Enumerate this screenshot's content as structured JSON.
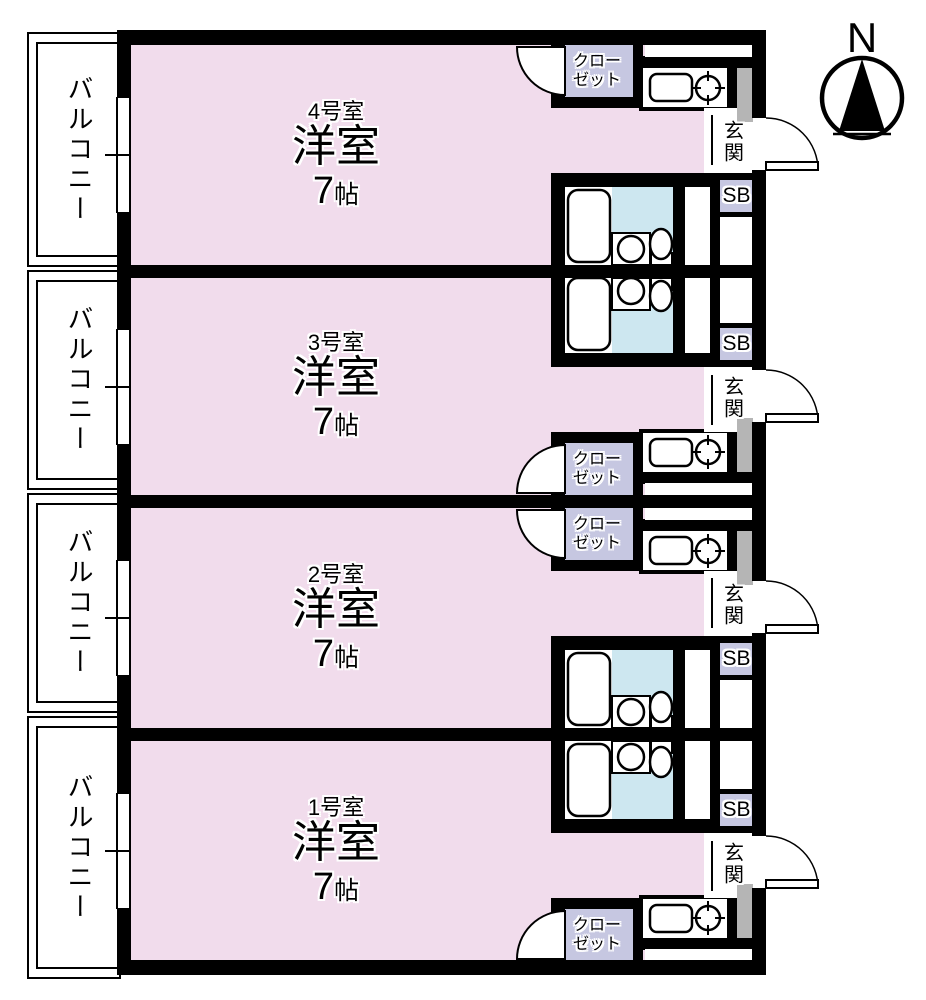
{
  "compass": {
    "north_label": "N"
  },
  "balconies": [
    {
      "label": "バルコニー"
    },
    {
      "label": "バルコニー"
    },
    {
      "label": "バルコニー"
    },
    {
      "label": "バルコニー"
    }
  ],
  "units": [
    {
      "number_label": "4号室"
    },
    {
      "number_label": "3号室"
    },
    {
      "number_label": "2号室"
    },
    {
      "number_label": "1号室"
    }
  ],
  "shared_labels": {
    "room_type": "洋室",
    "room_size_number": "7",
    "room_size_unit": "帖",
    "closet_line1": "クロー",
    "closet_line2": "ゼット",
    "entrance": "玄関",
    "shoe_box": "SB"
  },
  "colors": {
    "room_fill": "#f1dcec",
    "closet_fill": "#c6c7e1",
    "bath_floor_fill": "#cde7f0",
    "door_gray": "#b5b5b5",
    "wall": "#000000"
  }
}
